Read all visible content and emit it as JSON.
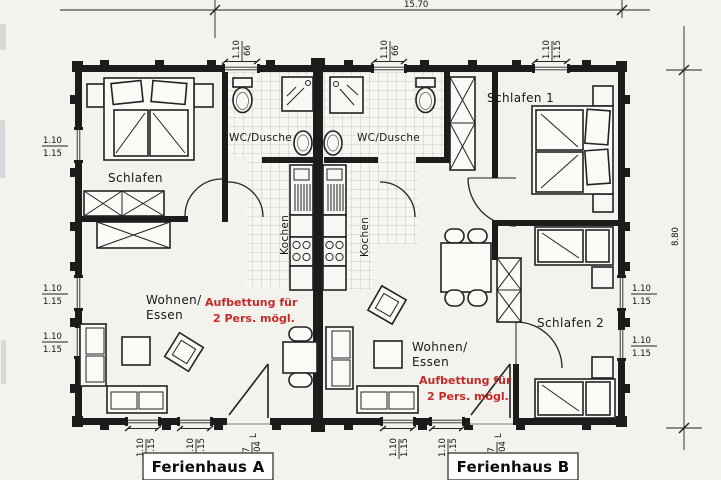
{
  "footer": {
    "house_a": "Ferienhaus A",
    "house_b": "Ferienhaus B"
  },
  "rooms": {
    "schlafen_a": "Schlafen",
    "wc_a": "WC/Dusche",
    "wc_b": "WC/Dusche",
    "kochen_a": "Kochen",
    "kochen_b": "Kochen",
    "schlafen_1": "Schlafen 1",
    "schlafen_2": "Schlafen 2",
    "wohnen_a_line1": "Wohnen/",
    "wohnen_a_line2": "Essen",
    "wohnen_b_line1": "Wohnen/",
    "wohnen_b_line2": "Essen"
  },
  "notes": {
    "aufbettung_line1": "Aufbettung für",
    "aufbettung_line2": "2 Pers. mögl.",
    "color": "#c42a2a"
  },
  "dims": {
    "total_width": "15.70",
    "total_height": "8.80",
    "wc_window": {
      "w": "1.10",
      "h": "66"
    },
    "std_window": {
      "w": "1.10",
      "h": "1.15"
    },
    "entry_door": {
      "w": "97",
      "h": "2.04",
      "suffix": "L"
    }
  }
}
